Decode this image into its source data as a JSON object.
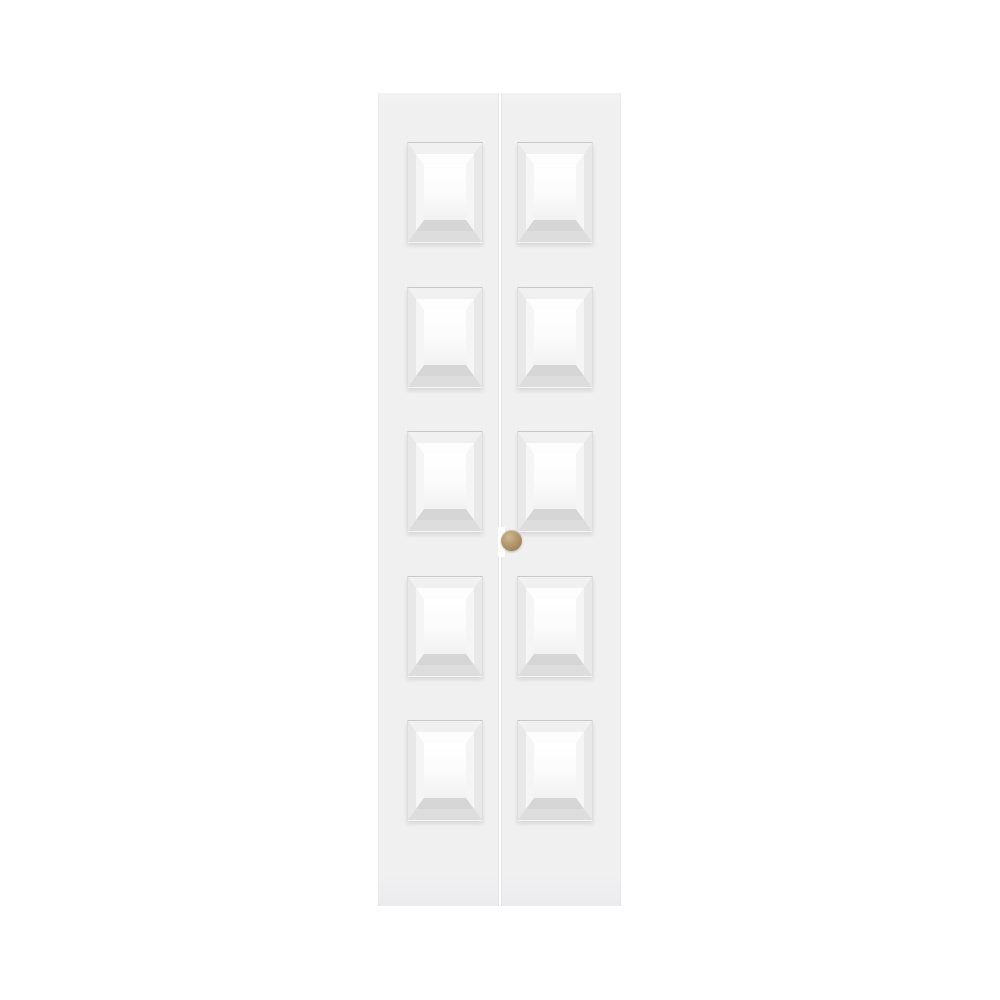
{
  "scene": {
    "type": "product-photo",
    "subject": "White 10-panel raised-panel bifold closet door, closed, front view",
    "background_color": "#ffffff"
  },
  "door": {
    "leaves": 2,
    "panels_per_leaf": 5,
    "panel_rows": 5,
    "panel_columns": 2,
    "total_panels": 10,
    "panel_style": "raised beveled rectangle",
    "seam_orientation": "vertical-center"
  },
  "knob": {
    "shape": "round",
    "finish": "brass",
    "position": "right leaf, beside center seam, mid-height"
  },
  "colors": {
    "background": "#ffffff",
    "door_face": "#f0f0f1",
    "seam": "#ffffff",
    "recess_top": "#c7c7c7",
    "recess_side": "#dedede",
    "recess_bottom": "#f3f3f3",
    "bevel_outer_top": "#f1f1f1",
    "bevel_outer_side": "#e8e8e8",
    "bevel_outer_bottom": "#dddddd",
    "bevel_inner_top": "#fdfdfd",
    "bevel_inner_side": "#f5f5f5",
    "bevel_inner_bottom": "#d6d6d6",
    "field_top": "#ffffff",
    "field_bottom": "#f1f1f1",
    "knob_highlight": "#cdb88c",
    "knob_base": "#b0966a",
    "knob_shadow": "#8a7148"
  }
}
